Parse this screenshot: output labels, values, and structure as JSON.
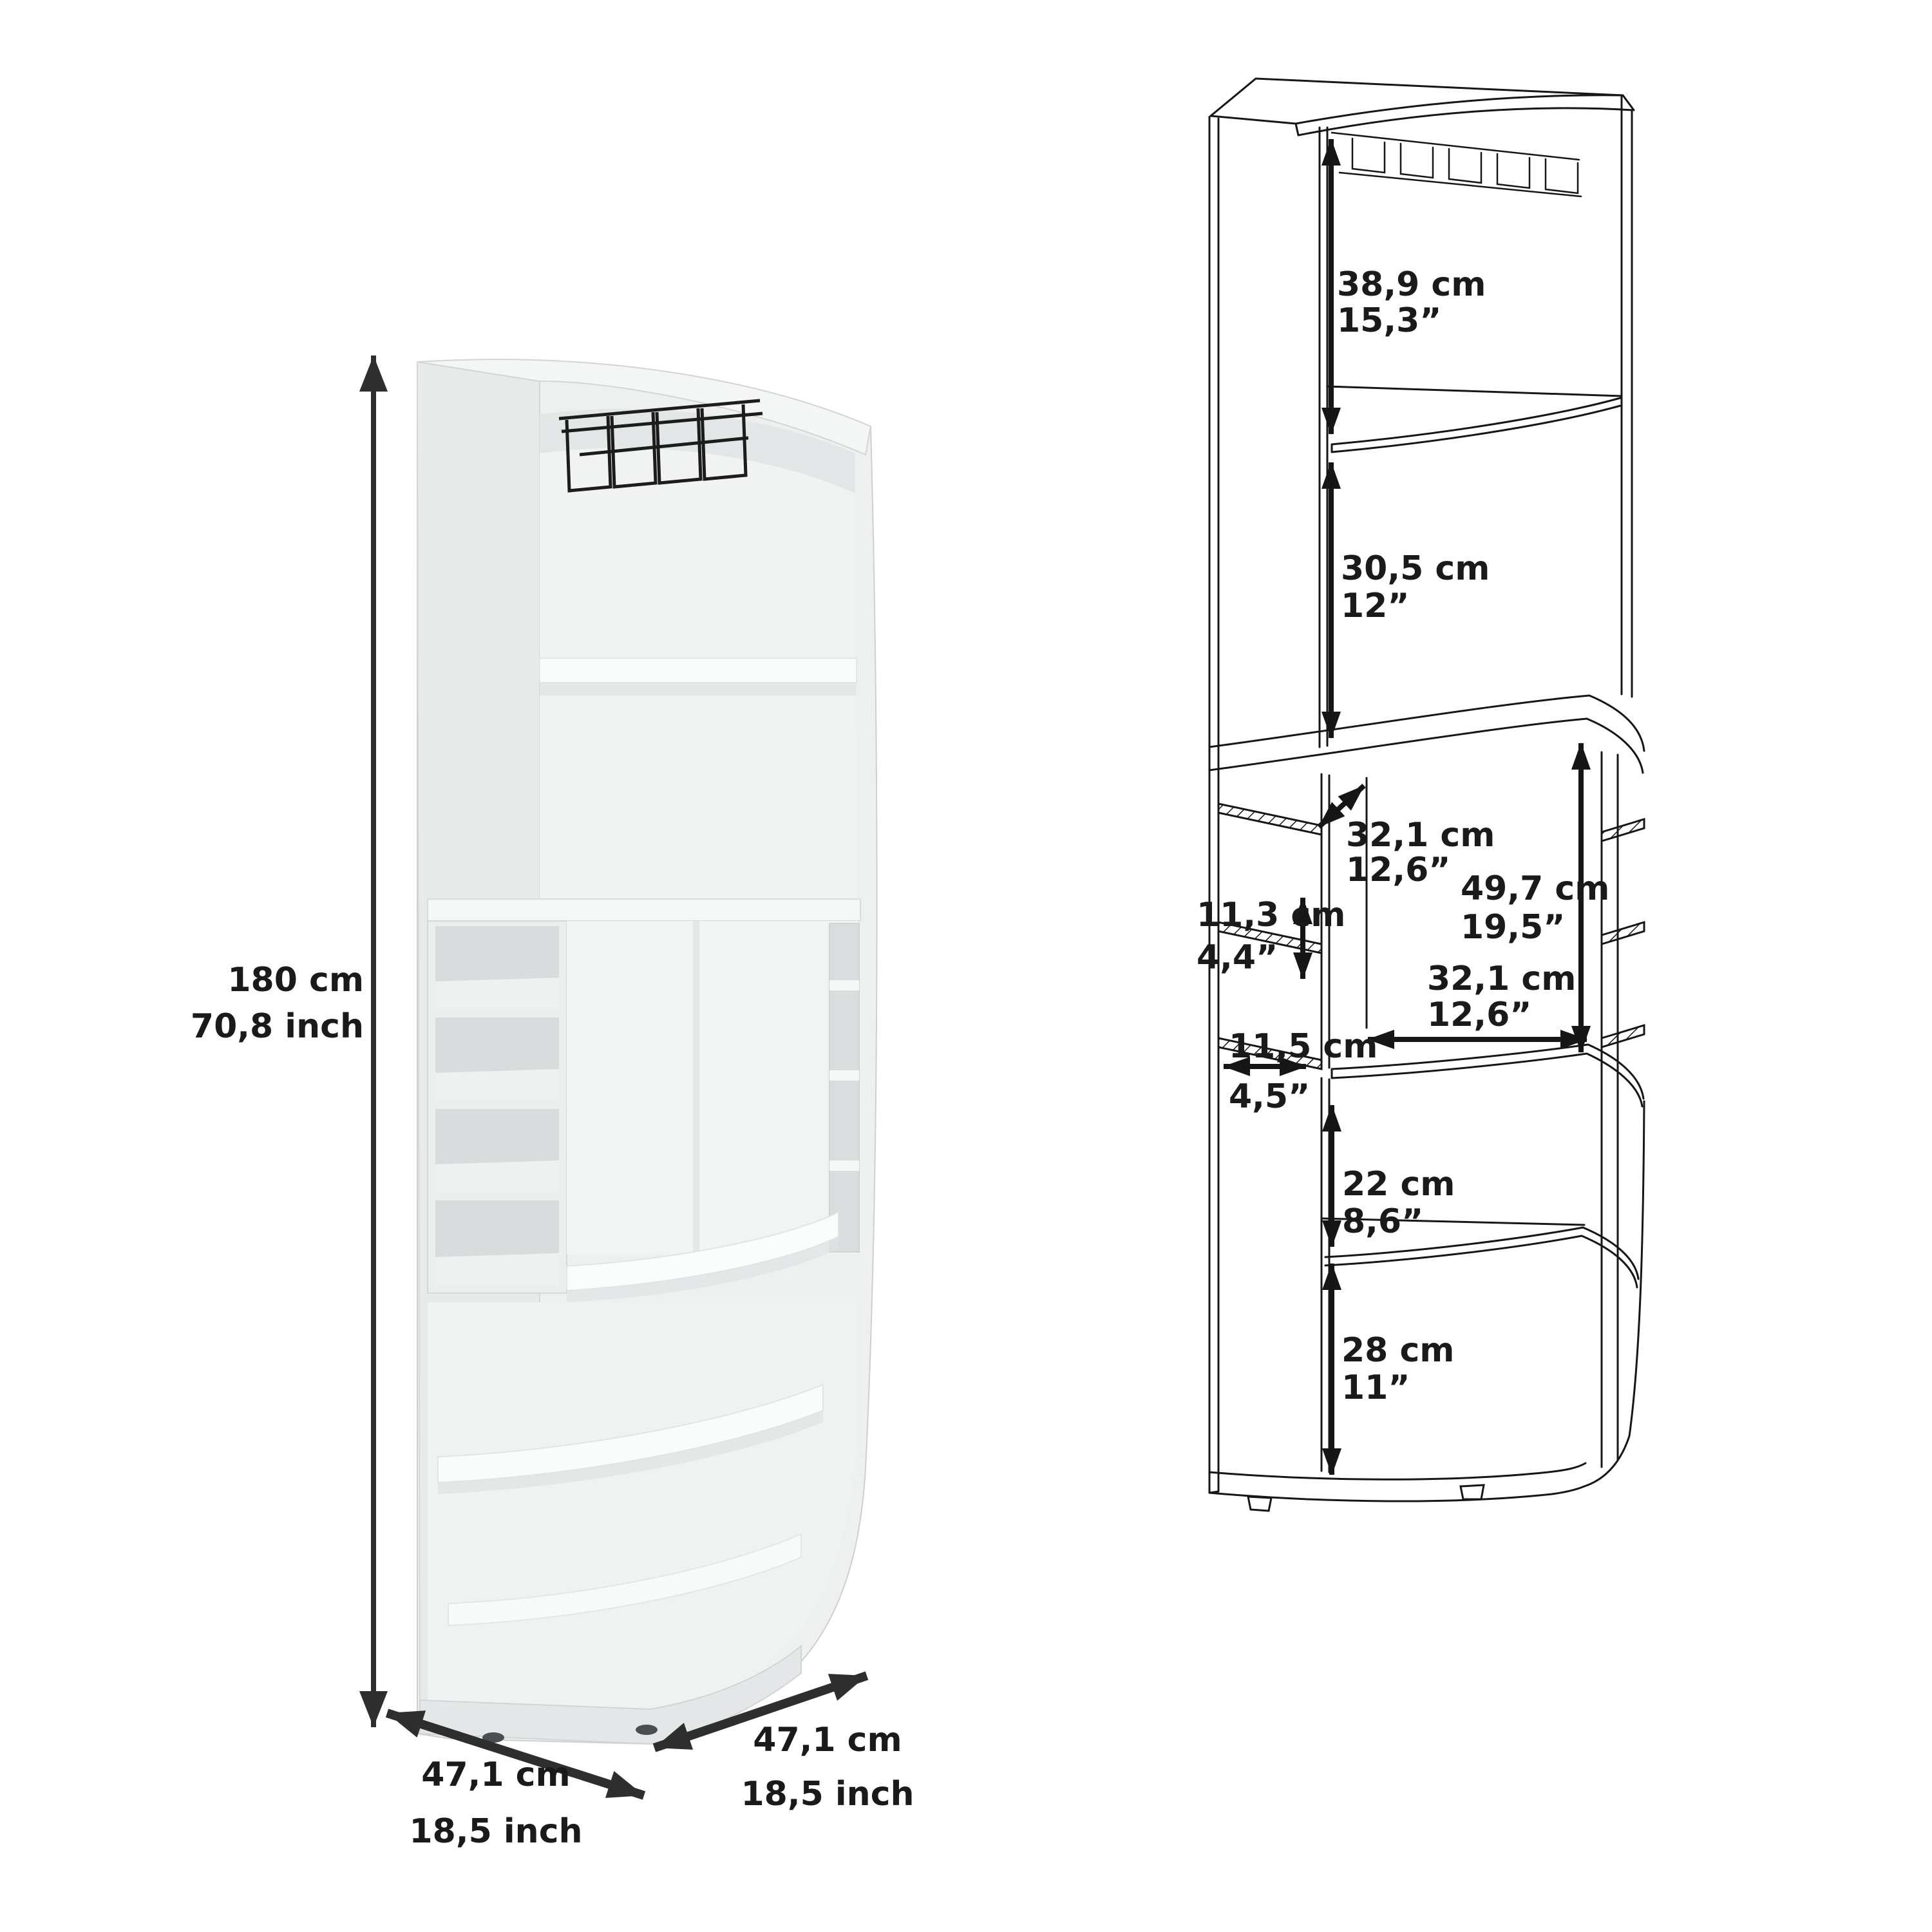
{
  "figure": {
    "left_name": "corner-bar-cabinet-rendered-view",
    "right_name": "corner-bar-cabinet-dimension-drawing"
  },
  "dimensions": {
    "height": {
      "cm": "180 cm",
      "inch": "70,8 inch"
    },
    "depth_left": {
      "cm": "47,1 cm",
      "inch": "18,5 inch"
    },
    "depth_right": {
      "cm": "47,1 cm",
      "inch": "18,5 inch"
    },
    "top_section": {
      "cm": "38,9 cm",
      "inch": "15,3”"
    },
    "upper_shelf": {
      "cm": "30,5 cm",
      "inch": "12”"
    },
    "mid_depth": {
      "cm": "32,1 cm",
      "inch": "12,6”"
    },
    "mid_opening_height": {
      "cm": "49,7 cm",
      "inch": "19,5”"
    },
    "cubby_height": {
      "cm": "11,3 cm",
      "inch": "4,4”"
    },
    "cubby_depth": {
      "cm": "11,5 cm",
      "inch": "4,5”"
    },
    "mid_opening_width": {
      "cm": "32,1 cm",
      "inch": "12,6”"
    },
    "lower_shelf": {
      "cm": "22 cm",
      "inch": "8,6”"
    },
    "bottom_shelf": {
      "cm": "28 cm",
      "inch": "11”"
    }
  },
  "colors": {
    "background": "#ffffff",
    "line_art": "#161616",
    "label_text": "#1a1a1a",
    "cabinet_body": "#eef0f0",
    "cabinet_panel": "#e8eaea",
    "cabinet_recess": "#d8dcdc",
    "cabinet_shelf": "#fafbfb",
    "glass_rack": "#1c1c1c",
    "dimension_arrow": "#2e2e2e"
  }
}
